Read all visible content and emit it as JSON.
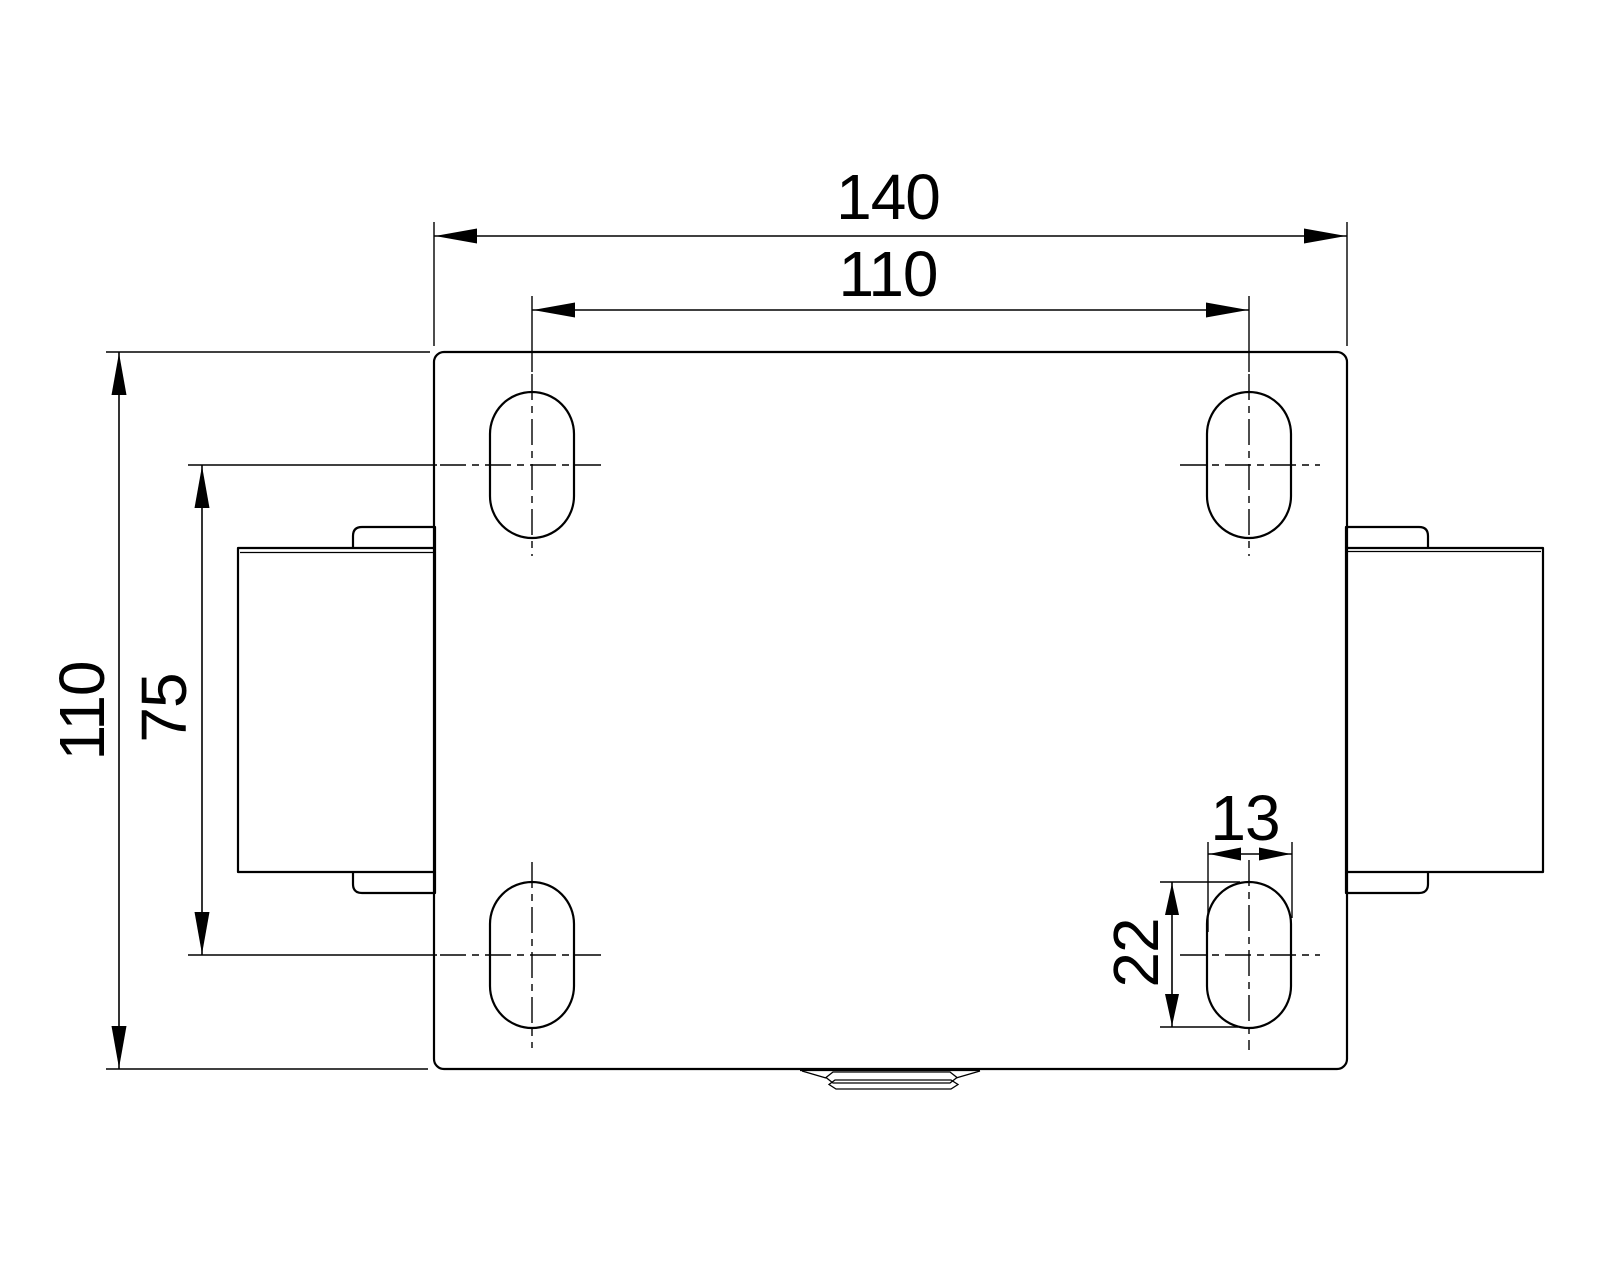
{
  "drawing": {
    "type": "technical-drawing-top-view-caster-plate",
    "labels": {
      "plate_width": "140",
      "hole_pitch_width": "110",
      "plate_height": "110",
      "hole_pitch_height": "75",
      "slot_width": "13",
      "slot_length": "22"
    },
    "colors": {
      "line": "#000000",
      "background": "#ffffff"
    }
  }
}
